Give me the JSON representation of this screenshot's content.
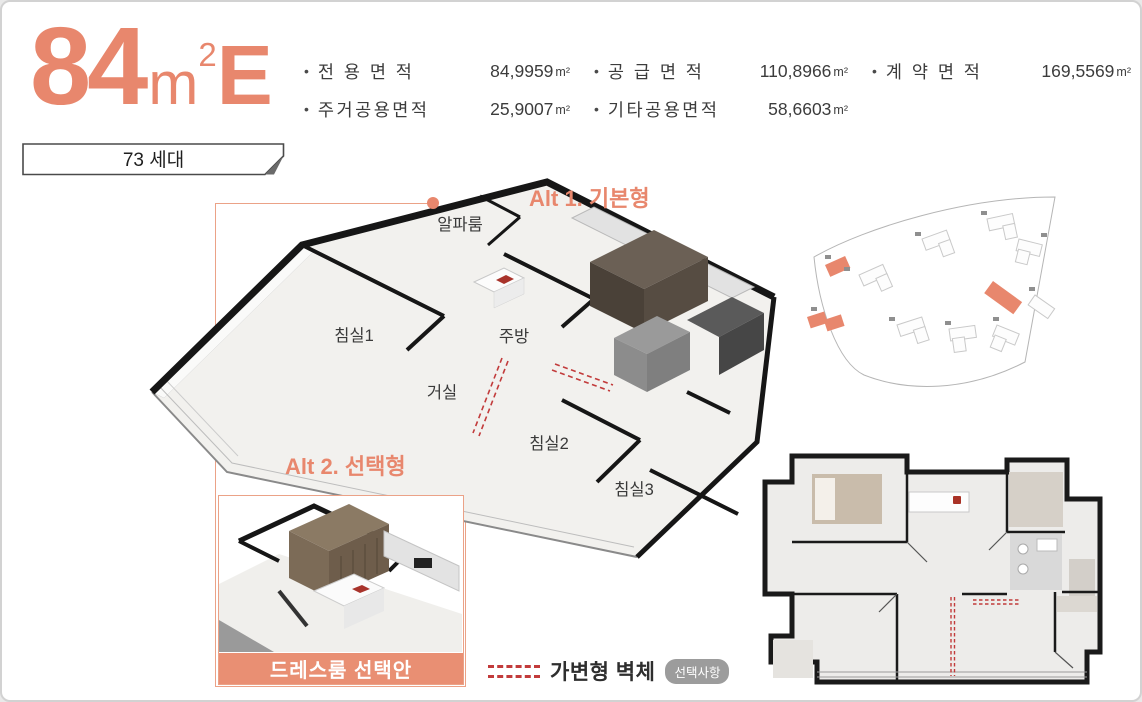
{
  "colors": {
    "accent": "#E8876D",
    "accent_line": "#EBA287",
    "banner": "#E98F73",
    "text_dark": "#3C3C3C",
    "badge_bg": "#9C9C9C",
    "wall_black": "#1A1A1A",
    "dash_red": "#C23B3B"
  },
  "header": {
    "unit_big": "84",
    "unit_mid": "m",
    "unit_sup": "2",
    "unit_tail": "E",
    "specs": [
      {
        "label": "전 용 면 적",
        "value": "84,9959",
        "unit": "m²"
      },
      {
        "label": "공 급 면 적",
        "value": "110,8966",
        "unit": "m²"
      },
      {
        "label": "계 약 면 적",
        "value": "169,5569",
        "unit": "m²"
      },
      {
        "label": "주거공용면적",
        "value": "25,9007",
        "unit": "m²"
      },
      {
        "label": "기타공용면적",
        "value": "58,6603",
        "unit": "m²"
      }
    ]
  },
  "units_badge": {
    "label": "73 세대"
  },
  "alt1": {
    "label": "Alt 1. 기본형",
    "rooms": {
      "alpha": "알파룸",
      "bed1": "침실1",
      "kitchen": "주방",
      "living": "거실",
      "bed2": "침실2",
      "bed3": "침실3"
    }
  },
  "alt2": {
    "label": "Alt 2. 선택형",
    "caption": "드레스룸 선택안"
  },
  "legend": {
    "label": "가변형 벽체",
    "badge": "선택사항"
  }
}
